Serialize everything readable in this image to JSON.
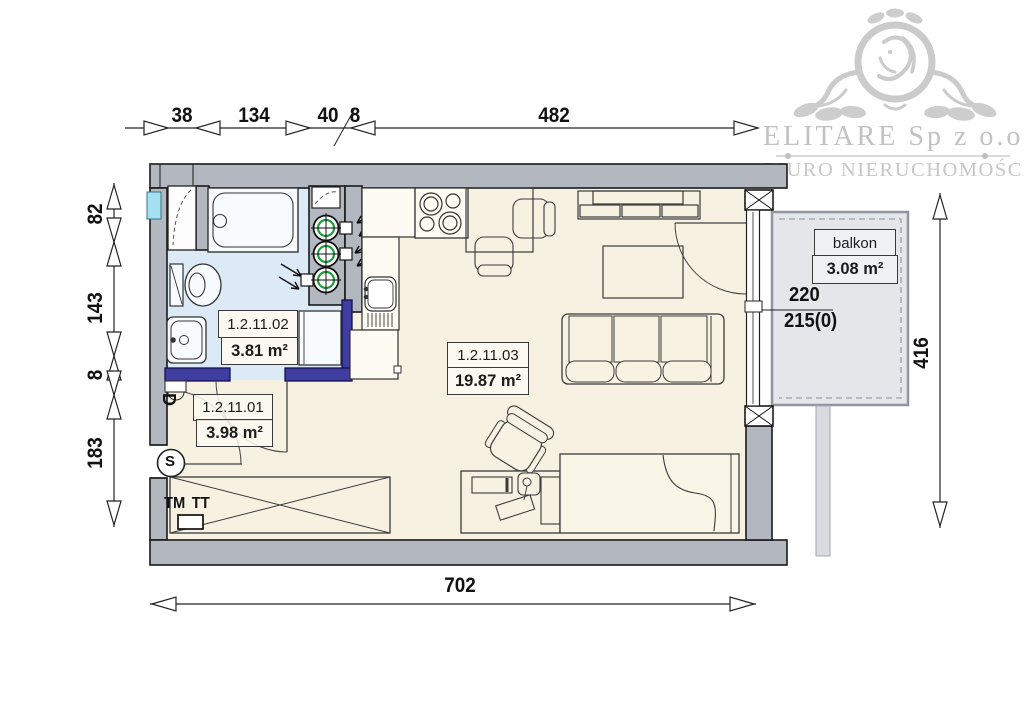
{
  "branding": {
    "company": "ELITARE Sp z o.o.",
    "tagline": "BIURO NIERUCHOMOŚCI"
  },
  "plan": {
    "rooms": [
      {
        "id": "1.2.11.01",
        "area": "3.98 m²"
      },
      {
        "id": "1.2.11.02",
        "area": "3.81 m²"
      },
      {
        "id": "1.2.11.03",
        "area": "19.87 m²"
      }
    ],
    "balcony": {
      "label": "balkon",
      "area": "3.08 m²"
    },
    "window_marks": {
      "width": "220",
      "sill": "215(0)"
    },
    "annotations": {
      "tm": "TM",
      "tt": "TT",
      "door_mark": "D",
      "meter_mark": "S"
    }
  },
  "dimensions": {
    "top": [
      "38",
      "134",
      "40",
      "8",
      "482"
    ],
    "left": [
      "82",
      "143",
      "8",
      "183"
    ],
    "bottom": [
      "702"
    ],
    "right": [
      "416"
    ]
  },
  "colors": {
    "wall_gray": "#b2b7c0",
    "new_wall_navy": "#403da0",
    "bathroom_floor": "#dbeaf6",
    "room_floor": "#f6f1e1",
    "balcony_slab": "#e4e6e9",
    "glass_cyan": "#a5dff2",
    "meter_green": "#1f9e3e",
    "logo_gray": "#c6c6c6"
  }
}
